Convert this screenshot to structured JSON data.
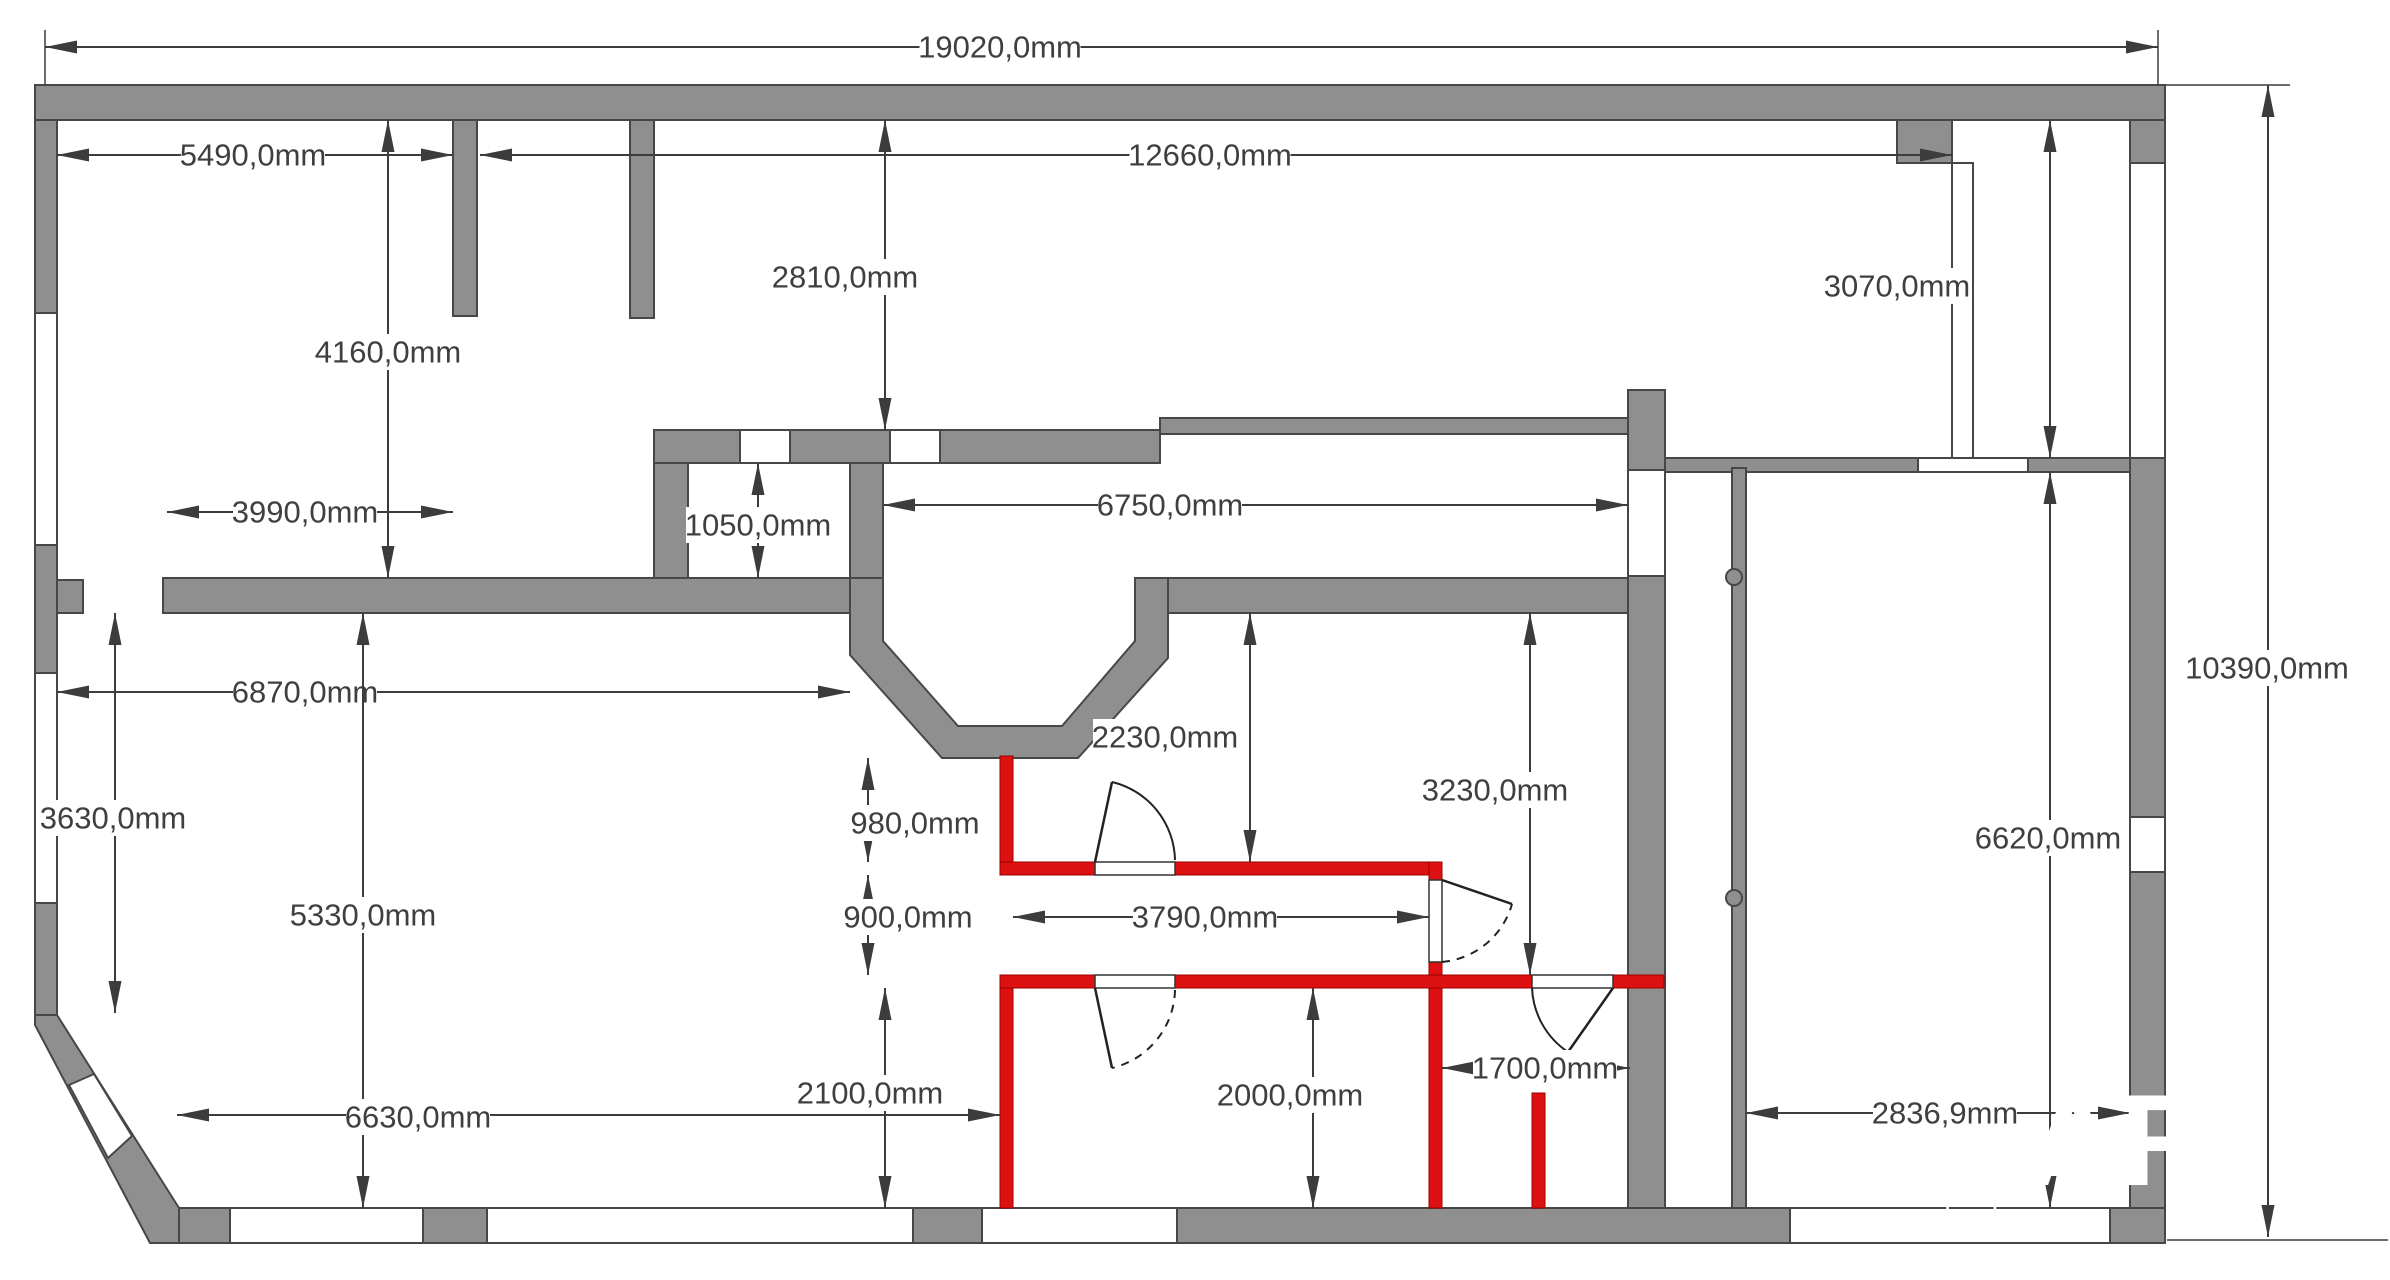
{
  "plan": {
    "canvas": {
      "width": 2390,
      "height": 1280,
      "background": "#ffffff"
    },
    "colors": {
      "wall_fill": "#8f8f8f",
      "wall_stroke": "#474747",
      "new_wall_fill": "#dd1111",
      "new_wall_stroke": "#9a0000",
      "window_fill": "#ffffff",
      "dim_line": "#3c3c3c",
      "dim_text": "#3f3f3f",
      "door_stroke": "#222222",
      "watermark": "#ffffff"
    },
    "walls_gray": [
      {
        "name": "top-wall",
        "r": [
          35,
          85,
          2130,
          35
        ]
      },
      {
        "name": "top-right-corner-block",
        "r": [
          1897,
          120,
          55,
          43
        ]
      },
      {
        "name": "left-wall-upper",
        "r": [
          35,
          120,
          22,
          193
        ]
      },
      {
        "name": "left-wall-middle",
        "r": [
          35,
          545,
          22,
          128
        ]
      },
      {
        "name": "left-wall-tee",
        "r": [
          57,
          580,
          26,
          33
        ]
      },
      {
        "name": "left-wall-lower",
        "r": [
          35,
          903,
          22,
          112
        ]
      },
      {
        "name": "right-wall-upper",
        "r": [
          2130,
          120,
          35,
          43
        ]
      },
      {
        "name": "right-wall-middle",
        "r": [
          2130,
          458,
          35,
          359
        ]
      },
      {
        "name": "right-wall-lower",
        "r": [
          2130,
          872,
          35,
          371
        ]
      },
      {
        "name": "bottom-wall",
        "r": [
          177,
          1208,
          1988,
          35
        ]
      },
      {
        "name": "partition-top-left",
        "r": [
          453,
          120,
          24,
          196
        ]
      },
      {
        "name": "partition-top-second",
        "r": [
          630,
          120,
          24,
          198
        ]
      },
      {
        "name": "corridor-band-thick",
        "r": [
          654,
          430,
          506,
          33
        ]
      },
      {
        "name": "closet-left-wall",
        "r": [
          654,
          463,
          34,
          115
        ]
      },
      {
        "name": "closet-right-wall",
        "r": [
          850,
          463,
          33,
          115
        ]
      },
      {
        "name": "corridor-band-thin",
        "r": [
          1160,
          418,
          468,
          16
        ]
      },
      {
        "name": "mid-wall-left",
        "r": [
          163,
          578,
          720,
          35
        ]
      },
      {
        "name": "mid-wall-right",
        "r": [
          1135,
          578,
          493,
          35
        ]
      },
      {
        "name": "interior-wall-vertical-main",
        "r": [
          1628,
          390,
          37,
          818
        ]
      },
      {
        "name": "right-rooms-top-wall",
        "r": [
          1665,
          458,
          465,
          14
        ]
      },
      {
        "name": "right-rooms-partition",
        "r": [
          1732,
          468,
          14,
          740
        ]
      }
    ],
    "polygons_gray": [
      {
        "name": "bay-chamfered-walls",
        "d": "M850,578 L850,655 L942,758 L1078,758 L1168,658 L1168,578 L1135,578 L1135,641 L1062,726 L958,726 L883,641 L883,578 Z"
      },
      {
        "name": "diagonal-wall-bottom-left",
        "d": "M35,1015 L57,1015 L179,1208 L179,1243 L150,1243 L35,1025 Z"
      }
    ],
    "windows": [
      {
        "name": "left-wall-window-upper",
        "r": [
          35,
          313,
          22,
          232
        ]
      },
      {
        "name": "left-wall-window-lower",
        "r": [
          35,
          673,
          22,
          230
        ]
      },
      {
        "name": "right-wall-window-upper",
        "r": [
          2130,
          163,
          35,
          295
        ]
      },
      {
        "name": "right-wall-window-lower",
        "r": [
          2130,
          817,
          35,
          55
        ]
      },
      {
        "name": "bottom-wall-window-1",
        "r": [
          230,
          1208,
          193,
          35
        ]
      },
      {
        "name": "bottom-wall-window-2",
        "r": [
          487,
          1208,
          426,
          35
        ]
      },
      {
        "name": "bottom-wall-window-3",
        "r": [
          982,
          1208,
          195,
          35
        ]
      },
      {
        "name": "bottom-wall-window-4",
        "r": [
          1790,
          1208,
          320,
          35
        ]
      },
      {
        "name": "corridor-band-opening-1",
        "r": [
          740,
          430,
          50,
          33
        ]
      },
      {
        "name": "corridor-band-opening-2",
        "r": [
          890,
          430,
          50,
          33
        ]
      },
      {
        "name": "right-rooms-top-opening",
        "r": [
          1918,
          458,
          110,
          14
        ]
      },
      {
        "name": "interior-wall-door-gap",
        "r": [
          1628,
          470,
          37,
          106
        ]
      },
      {
        "name": "glazed-strip-top-right",
        "r": [
          1952,
          163,
          21,
          295
        ]
      }
    ],
    "window_polygons": [
      {
        "name": "diagonal-wall-window",
        "d": "M69,1085 L94,1074 L132,1136 L108,1158 Z"
      }
    ],
    "walls_red": [
      {
        "name": "new-wall-bay-stub",
        "r": [
          1000,
          756,
          13,
          119
        ]
      },
      {
        "name": "new-wall-upper-horizontal",
        "r": [
          1000,
          862,
          442,
          13
        ]
      },
      {
        "name": "new-wall-right-vertical-upper",
        "r": [
          1429,
          862,
          13,
          126
        ]
      },
      {
        "name": "new-wall-lower-horizontal",
        "r": [
          1000,
          975,
          664,
          13
        ]
      },
      {
        "name": "new-wall-left-vertical-lower",
        "r": [
          1000,
          988,
          13,
          220
        ]
      },
      {
        "name": "new-wall-right-vertical-lower",
        "r": [
          1429,
          988,
          13,
          220
        ]
      },
      {
        "name": "new-wall-wc-stub",
        "r": [
          1532,
          1093,
          13,
          115
        ]
      }
    ],
    "red_openings": [
      {
        "name": "door-opening-upper",
        "r": [
          1095,
          862,
          80,
          13
        ]
      },
      {
        "name": "door-opening-lower",
        "r": [
          1095,
          975,
          80,
          13
        ]
      },
      {
        "name": "door-opening-side",
        "r": [
          1429,
          880,
          13,
          82
        ]
      },
      {
        "name": "door-opening-wc",
        "r": [
          1532,
          975,
          81,
          13
        ]
      }
    ],
    "doors": [
      {
        "name": "door-upper-room",
        "leaf": "M1095,862 L1112,782",
        "arc": "M1175,860 A82,82 0 0 0 1112,782",
        "dashed": false
      },
      {
        "name": "door-lower-room",
        "leaf": "M1095,988 L1112,1068",
        "arc": "M1175,990 A82,82 0 0 1 1112,1068",
        "dashed": true
      },
      {
        "name": "door-side-room",
        "leaf": "M1442,880 L1512,904",
        "arc": "M1442,962 A80,80 0 0 0 1512,904",
        "dashed": true
      },
      {
        "name": "door-wc",
        "leaf": "M1613,988 L1568,1052",
        "arc": "M1532,988 A81,81 0 0 0 1568,1052",
        "dashed": false
      }
    ],
    "knobs": [
      {
        "name": "door-knob-upper",
        "c": [
          1734,
          577,
          8
        ]
      },
      {
        "name": "door-knob-lower",
        "c": [
          1734,
          898,
          8
        ]
      }
    ],
    "dimensions": [
      {
        "label": "19020,0mm",
        "lx": 1000,
        "ly": 47,
        "line": [
          45,
          47,
          2158,
          47
        ],
        "ext": [
          [
            45,
            30,
            45,
            85
          ],
          [
            2158,
            30,
            2158,
            85
          ]
        ]
      },
      {
        "label": "5490,0mm",
        "lx": 253,
        "ly": 155,
        "line": [
          57,
          155,
          453,
          155
        ],
        "ext": []
      },
      {
        "label": "12660,0mm",
        "lx": 1210,
        "ly": 155,
        "line": [
          480,
          155,
          1952,
          155
        ],
        "ext": []
      },
      {
        "label": "2810,0mm",
        "lx": 845,
        "ly": 277,
        "line": [
          885,
          120,
          885,
          430
        ],
        "ext": []
      },
      {
        "label": "4160,0mm",
        "lx": 388,
        "ly": 352,
        "line": [
          388,
          120,
          388,
          578
        ],
        "ext": []
      },
      {
        "label": "3070,0mm",
        "lx": 1897,
        "ly": 286,
        "line": [
          2050,
          120,
          2050,
          458
        ],
        "ext": []
      },
      {
        "label": "3990,0mm",
        "lx": 305,
        "ly": 512,
        "line": [
          167,
          512,
          453,
          512
        ],
        "ext": []
      },
      {
        "label": "1050,0mm",
        "lx": 758,
        "ly": 525,
        "line": [
          758,
          463,
          758,
          578
        ],
        "ext": []
      },
      {
        "label": "6750,0mm",
        "lx": 1170,
        "ly": 505,
        "line": [
          883,
          505,
          1628,
          505
        ],
        "ext": []
      },
      {
        "label": "6870,0mm",
        "lx": 305,
        "ly": 692,
        "line": [
          57,
          692,
          850,
          692
        ],
        "ext": []
      },
      {
        "label": "10390,0mm",
        "lx": 2267,
        "ly": 668,
        "line": [
          2268,
          85,
          2268,
          1237
        ],
        "ext": [
          [
            2165,
            85,
            2290,
            85
          ],
          [
            2167,
            1240,
            2388,
            1240
          ]
        ]
      },
      {
        "label": "3630,0mm",
        "lx": 113,
        "ly": 818,
        "line": [
          115,
          613,
          115,
          1013
        ],
        "ext": []
      },
      {
        "label": "5330,0mm",
        "lx": 363,
        "ly": 915,
        "line": [
          363,
          613,
          363,
          1208
        ],
        "ext": []
      },
      {
        "label": "6630,0mm",
        "lx": 418,
        "ly": 1117,
        "line": [
          177,
          1115,
          1000,
          1115
        ],
        "ext": []
      },
      {
        "label": "980,0mm",
        "lx": 915,
        "ly": 823,
        "line": [
          868,
          758,
          868,
          862
        ],
        "ext": []
      },
      {
        "label": "900,0mm",
        "lx": 908,
        "ly": 917,
        "line": [
          868,
          875,
          868,
          975
        ],
        "ext": []
      },
      {
        "label": "3790,0mm",
        "lx": 1205,
        "ly": 917,
        "line": [
          1013,
          917,
          1429,
          917
        ],
        "ext": []
      },
      {
        "label": "2230,0mm",
        "lx": 1165,
        "ly": 737,
        "line": [
          1250,
          613,
          1250,
          862
        ],
        "ext": []
      },
      {
        "label": "3230,0mm",
        "lx": 1495,
        "ly": 790,
        "line": [
          1530,
          613,
          1530,
          975
        ],
        "ext": []
      },
      {
        "label": "2100,0mm",
        "lx": 870,
        "ly": 1093,
        "line": [
          885,
          988,
          885,
          1208
        ],
        "ext": []
      },
      {
        "label": "2000,0mm",
        "lx": 1290,
        "ly": 1095,
        "line": [
          1313,
          988,
          1313,
          1208
        ],
        "ext": []
      },
      {
        "label": "1700,0mm",
        "lx": 1545,
        "ly": 1068,
        "line": [
          1442,
          1068,
          1630,
          1068
        ],
        "ext": []
      },
      {
        "label": "2836,9mm",
        "lx": 1945,
        "ly": 1113,
        "line": [
          1746,
          1113,
          2130,
          1113
        ],
        "ext": []
      },
      {
        "label": "6620,0mm",
        "lx": 2048,
        "ly": 838,
        "line": [
          2050,
          472,
          2050,
          1208
        ],
        "ext": []
      }
    ],
    "watermark": {
      "large_text": "AR",
      "large_pos": [
        2120,
        1185
      ],
      "large_size": 130,
      "small_text": "T  L",
      "small_pos": [
        1980,
        1222
      ],
      "small_size": 28
    }
  }
}
